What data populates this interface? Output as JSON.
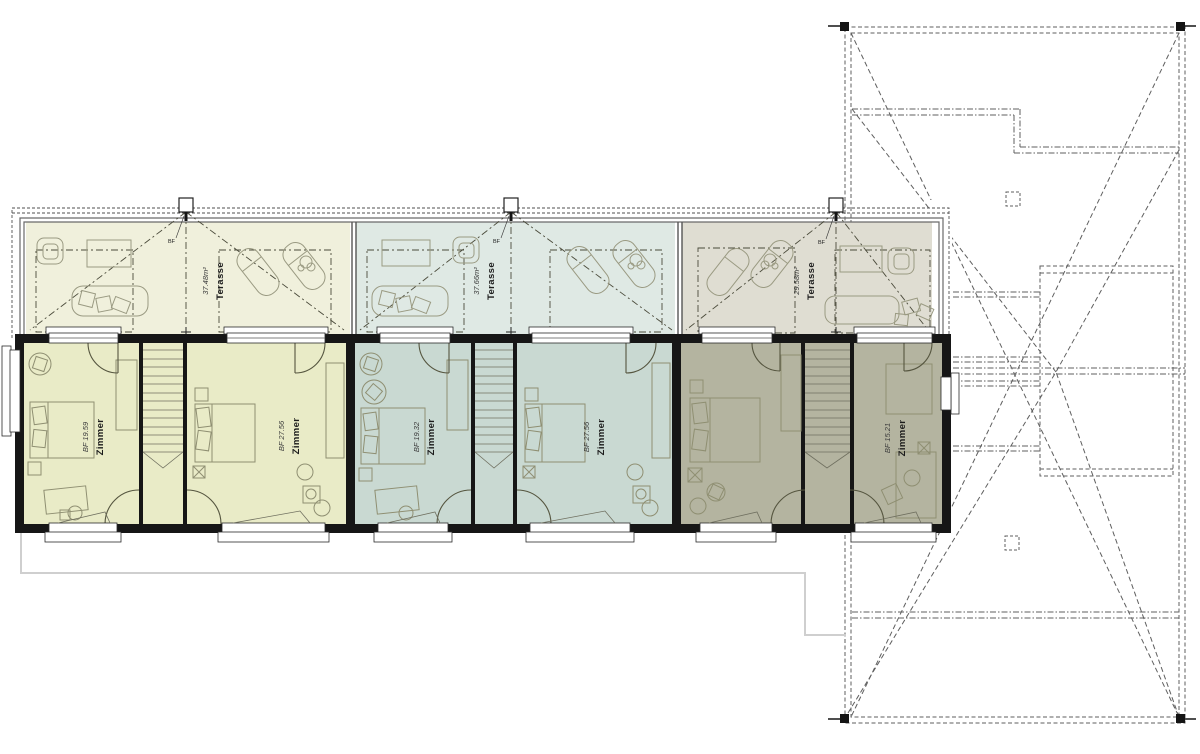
{
  "plan": {
    "title_hidden": "",
    "bf_marker_label": "BF",
    "colors": {
      "wall": "#161616",
      "unit1_room": "#e9ebc7",
      "unit1_terrace": "#f0f0dc",
      "unit2_room": "#c9d9d2",
      "unit2_terrace": "#dfe9e4",
      "unit3_room": "#b4b4a0",
      "unit3_terrace": "#dfddd2",
      "furniture_line": "#8f8f72",
      "roof_line": "#5f5f5f",
      "ground_outline": "#cfcfcf"
    },
    "units": [
      {
        "name": "unit-1",
        "terrace": {
          "area": "37.48m²",
          "label": "Terasse"
        },
        "rooms": [
          {
            "area": "BF 19.59",
            "label": "Zimmer"
          },
          {
            "area": "BF 27.56",
            "label": "Zimmer"
          }
        ]
      },
      {
        "name": "unit-2",
        "terrace": {
          "area": "37.66m²",
          "label": "Terasse"
        },
        "rooms": [
          {
            "area": "BF 19.32",
            "label": "Zimmer"
          },
          {
            "area": "BF 27.56",
            "label": "Zimmer"
          }
        ]
      },
      {
        "name": "unit-3",
        "terrace": {
          "area": "29.58m²",
          "label": "Terasse"
        },
        "rooms": [
          {
            "area": "",
            "label": ""
          },
          {
            "area": "BF 15.21",
            "label": "Zimmer"
          }
        ]
      }
    ]
  }
}
